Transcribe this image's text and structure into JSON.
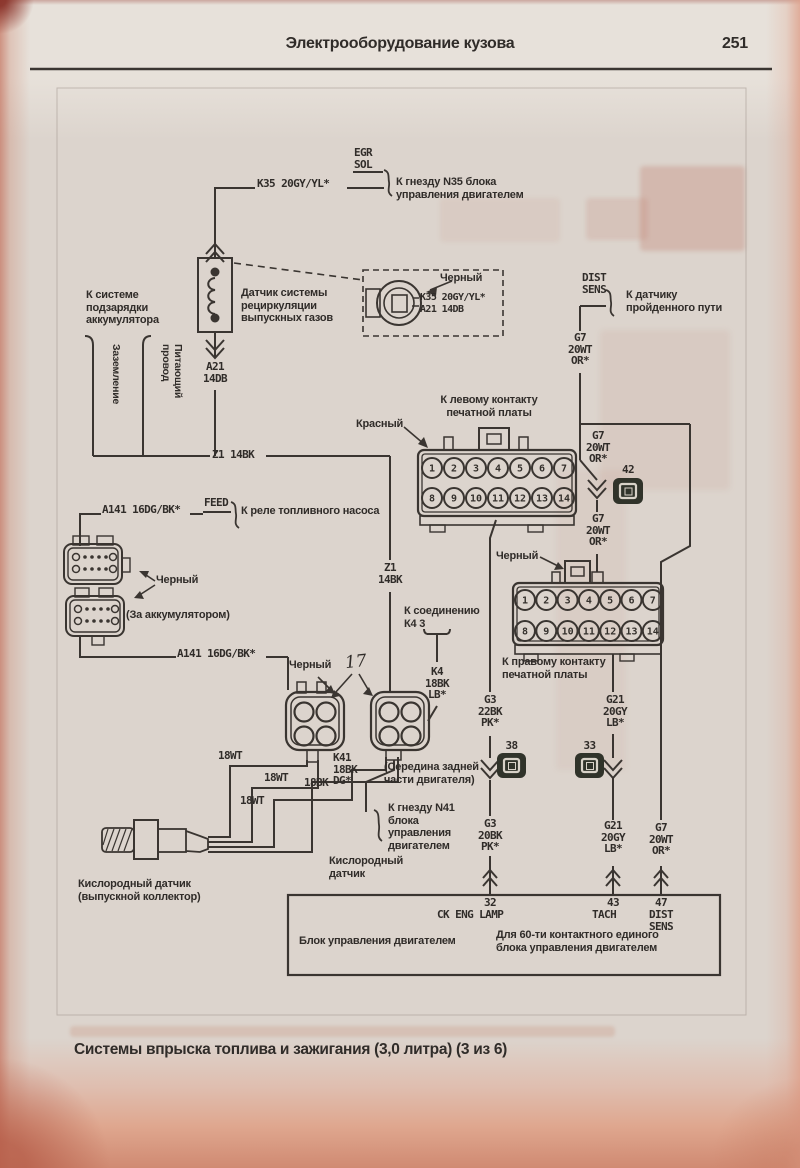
{
  "header": {
    "title": "Электрооборудование кузова",
    "page_number": "251"
  },
  "caption": "Системы впрыска топлива и зажигания (3,0 литра) (3 из 6)",
  "labels": {
    "egr_tag": "EGR\nSOL",
    "k35": "K35 20GY/YL*",
    "n35_dest": "К гнезду N35 блока\nуправления двигателем",
    "egr_sensor": "Датчик системы\nрециркуляции\nвыпускных газов",
    "charge_dest": "К системе\nподзарядки\nаккумулятора",
    "ground": "Заземление",
    "supply": "Питающий\nпровод",
    "a21": "A21\n14DB",
    "a21_inline": "A21 14DB",
    "black": "Черный",
    "dist_tag": "DIST\nSENS",
    "dist_dest": "К датчику\nпройденного пути",
    "g7": "G7\n20WT\nOR*",
    "n42": "42",
    "n38": "38",
    "n33": "33",
    "n17": "17",
    "z1_h": "Z1 14BK",
    "z1_v": "Z1\n14BK",
    "left_pcb": "К левому контакту\nпечатной платы",
    "red": "Красный",
    "right_pcb": "К правому контакту\nпечатной платы",
    "a141": "A141 16DG/BK*",
    "feed": "FEED",
    "pump_dest": "К реле топливного насоса",
    "behind_battery": "(За аккумулятором)",
    "k4_splice": "К соединению\nК4 3",
    "k4": "K4\n18BK\nLB*",
    "g3_22": "G3\n22BK\nPK*",
    "g3_20": "G3\n20BK\nPK*",
    "g21": "G21\n20GY\nLB*",
    "k41": "K41\n18BK\nDG*",
    "k41_note": "(Середина задней\nчасти двигателя)",
    "n41_dest": "К гнезду N41\nблока\nуправления\nдвигателем",
    "w18wt": "18WT",
    "w18bk": "18BK",
    "oxygen": "Кислородный\nдатчик",
    "oxygen_manifold": "Кислородный датчик\n(выпускной коллектор)"
  },
  "ecu": {
    "p32": "32",
    "p32_name": "CK ENG LAMP",
    "p43": "43",
    "p43_name": "TACH",
    "p47": "47",
    "p47_name": "DIST\nSENS",
    "name": "Блок управления двигателем",
    "note": "Для 60-ти контактного единого\nблока управления двигателем"
  },
  "pins": {
    "row1": [
      "1",
      "2",
      "3",
      "4",
      "5",
      "6",
      "7"
    ],
    "row2": [
      "8",
      "9",
      "10",
      "11",
      "12",
      "13",
      "14"
    ]
  }
}
